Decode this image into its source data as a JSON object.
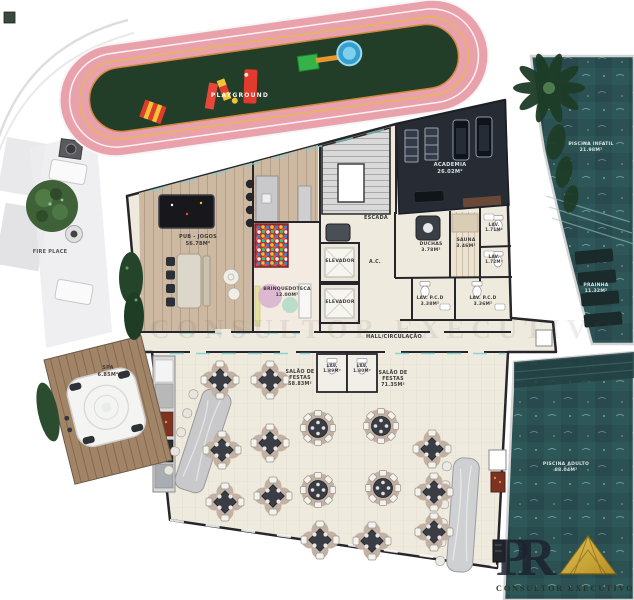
{
  "site": {
    "playground": {
      "label": "PLAYGROUND"
    },
    "fire_place": {
      "label": "FIRE PLACE"
    },
    "spa": {
      "label": "SPA",
      "area": "6.85m²"
    },
    "piscina_infantil": {
      "label": "PISCINA INFATIL",
      "area": "21.98m²"
    },
    "prainha": {
      "label": "PRAINHA",
      "area": "11.32m²"
    },
    "piscina_adulto": {
      "label": "PISCINA ADULTO",
      "area": "88.04m²"
    }
  },
  "rooms": {
    "pub_jogos": {
      "label": "PUB - JOGOS",
      "area": "56.78m²"
    },
    "brinquedoteca": {
      "label": "BRINQUEDOTECA",
      "area": "12.00m²"
    },
    "escada": {
      "label": "ESCADA"
    },
    "elevador_1": {
      "label": "ELEVADOR"
    },
    "elevador_2": {
      "label": "ELEVADOR"
    },
    "ac": {
      "label": "A.C."
    },
    "academia": {
      "label": "ACADEMIA",
      "area": "26.02m²"
    },
    "duchas": {
      "label": "DUCHAS",
      "area": "3.78m²"
    },
    "sauna": {
      "label": "SAUNA",
      "area": "3.46m²"
    },
    "lav_1": {
      "label": "LAV.",
      "area": "1.71m²"
    },
    "lav_2": {
      "label": "LAV.",
      "area": "1.72m²"
    },
    "lav_pcd_1": {
      "label": "LAV. P.C.D",
      "area": "3.38m²"
    },
    "lav_pcd_2": {
      "label": "LAV. P.C.D",
      "area": "3.36m²"
    },
    "hall": {
      "label": "HALL/CIRCULAÇÃO"
    },
    "lav_3": {
      "label": "LAV.",
      "area": "1.89m²"
    },
    "lav_4": {
      "label": "LAV.",
      "area": "1.80m²"
    },
    "salao_festas_1": {
      "label": "SALÃO DE FESTAS",
      "area": "58.83m²"
    },
    "salao_festas_2": {
      "label": "SALÃO DE FESTAS",
      "area": "71.35m²"
    }
  },
  "branding": {
    "logo_initials": "PR",
    "logo_tagline": "CONSULTOR EXECUTIVO",
    "watermark": "CONSULTOR EXECUTIVO",
    "gold": "#c9a22e"
  }
}
